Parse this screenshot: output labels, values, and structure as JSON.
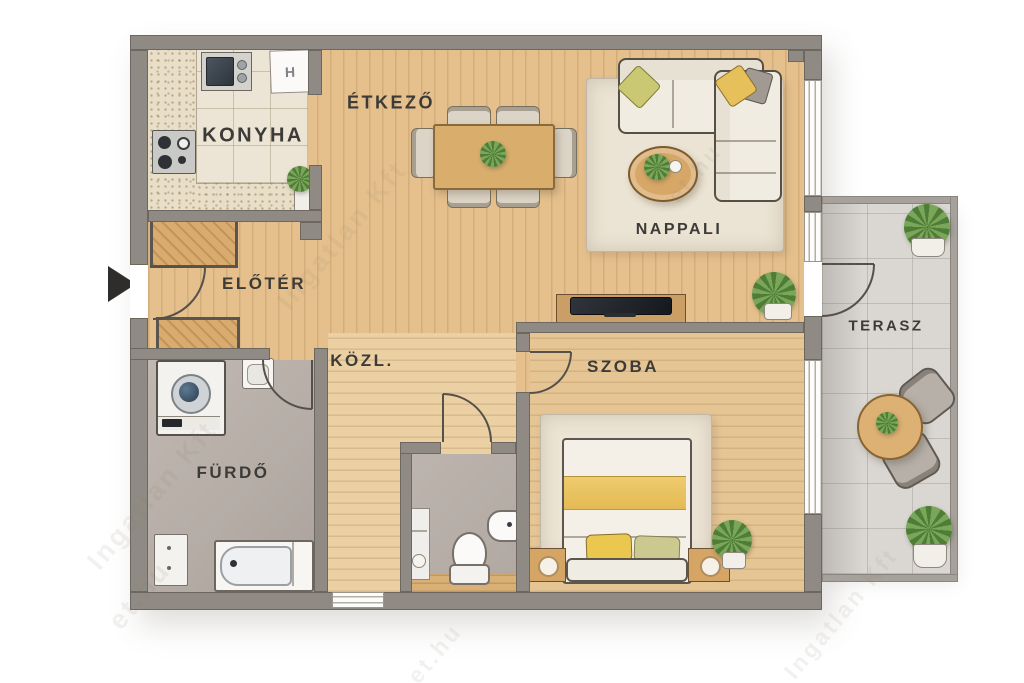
{
  "image_type": "apartment floor plan, top-down rendered",
  "rooms": {
    "konyha": {
      "label": "KONYHA"
    },
    "etkezo": {
      "label": "ÉTKEZŐ"
    },
    "nappali": {
      "label": "NAPPALI"
    },
    "eloter": {
      "label": "ELŐTÉR"
    },
    "kozl": {
      "label": "KÖZL."
    },
    "szoba": {
      "label": "SZOBA"
    },
    "furdo": {
      "label": "FÜRDŐ"
    },
    "terasz": {
      "label": "TERASZ"
    }
  },
  "appliances": {
    "fridge_label": "H"
  },
  "watermark": {
    "fragments": [
      "et.hu",
      "Ingatlan Kft"
    ]
  },
  "colors": {
    "wall": "#8f8a83",
    "wood_living": "#e5c08c",
    "wood_hall": "#ead0a3",
    "wood_bedroom": "#e6c595",
    "kitchen_tile": "#ece5d6",
    "bath_floor": "#b4aca5",
    "terrace_tile": "#dad7d2",
    "rug": "#ebe3d3",
    "accent_yellow": "#e6c05a",
    "accent_green": "#cbc873",
    "sofa": "#f1ece2"
  }
}
